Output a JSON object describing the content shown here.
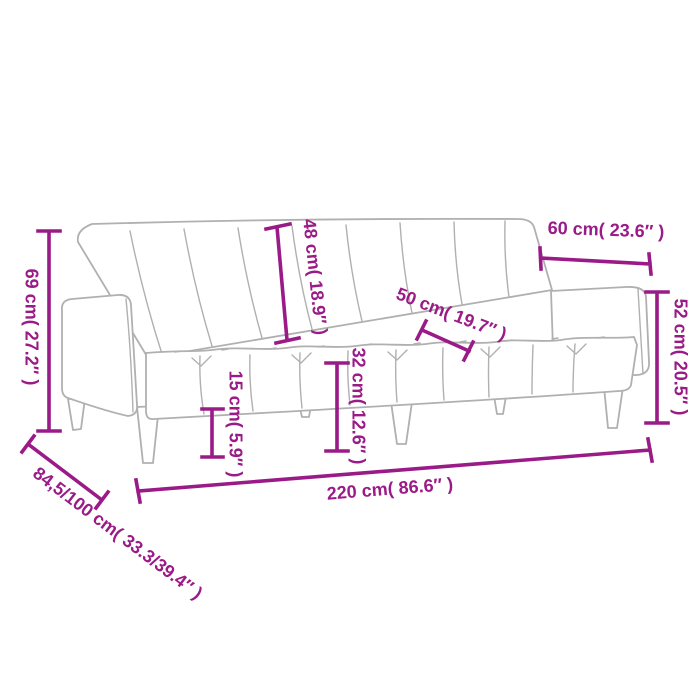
{
  "page": {
    "background": "#ffffff"
  },
  "colors": {
    "dimension_accent": "#9a1b87",
    "drawing_outline": "#b0b0b0",
    "background": "#ffffff"
  },
  "drawing": {
    "subject": "sofa-bed line drawing",
    "parts": [
      "backrest",
      "left-armrest",
      "right-armrest",
      "seat",
      "legs"
    ]
  },
  "measurements": [
    {
      "id": "overall-height",
      "cm": "69",
      "in": "27.2",
      "label": "69 cm( 27.2″ )"
    },
    {
      "id": "backrest-height",
      "cm": "48",
      "in": "18.9",
      "label": "48 cm( 18.9″ )"
    },
    {
      "id": "top-depth",
      "cm": "60",
      "in": "23.6",
      "label": "60 cm( 23.6″ )"
    },
    {
      "id": "armrest-height",
      "cm": "52",
      "in": "20.5",
      "label": "52 cm( 20.5″ )"
    },
    {
      "id": "seat-depth",
      "cm": "50",
      "in": "19.7",
      "label": "50 cm( 19.7″ )"
    },
    {
      "id": "leg-height",
      "cm": "15",
      "in": "5.9",
      "label": "15 cm( 5.9″ )"
    },
    {
      "id": "seat-height",
      "cm": "32",
      "in": "12.6",
      "label": "32 cm( 12.6″ )"
    },
    {
      "id": "overall-width",
      "cm": "220",
      "in": "86.6",
      "label": "220 cm( 86.6″ )"
    },
    {
      "id": "overall-depth",
      "cm": "84,5/100",
      "in": "33.3/39.4",
      "label": "84,5/100 cm( 33.3/39.4″ )"
    }
  ]
}
